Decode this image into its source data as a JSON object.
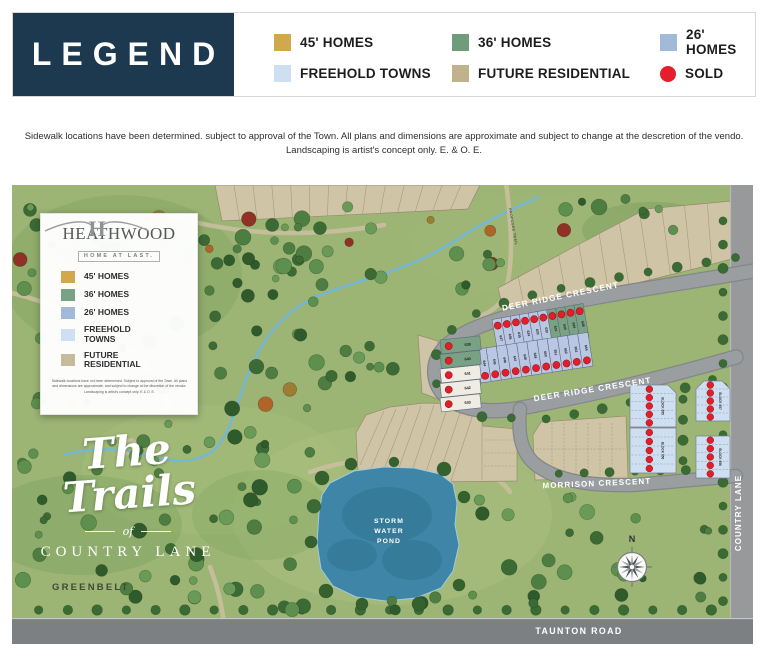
{
  "legend_bar": {
    "title": "LEGEND",
    "rows": [
      [
        {
          "label": "45' HOMES",
          "color": "#d2a84e",
          "shape": "square"
        },
        {
          "label": "36' HOMES",
          "color": "#6f9d7b",
          "shape": "square"
        },
        {
          "label": "26' HOMES",
          "color": "#a3b9d9",
          "shape": "square"
        }
      ],
      [
        {
          "label": "FREEHOLD TOWNS",
          "color": "#cfdff2",
          "shape": "square"
        },
        {
          "label": "FUTURE RESIDENTIAL",
          "color": "#bfb28c",
          "shape": "square"
        },
        {
          "label": "SOLD",
          "color": "#e41f2c",
          "shape": "circle"
        }
      ]
    ]
  },
  "disclaimer": "Sidewalk locations have been determined. subject to approval of the Town. All plans and dimensions are approximate and subject to change at the descretion of the vendo. Landscaping is artist's concept only. E. & O. E.",
  "map": {
    "card": {
      "monogram": "H",
      "brand": "HEATHWOOD",
      "tagline": "HOME AT LAST.",
      "items": [
        {
          "label": "45' HOMES",
          "color": "#d2a84e"
        },
        {
          "label": "36' HOMES",
          "color": "#79a183"
        },
        {
          "label": "26' HOMES",
          "color": "#a3b9d9"
        },
        {
          "label": "FREEHOLD TOWNS",
          "color": "#cfdff2"
        },
        {
          "label": "FUTURE RESIDENTIAL",
          "color": "#c6bb9b"
        }
      ],
      "fine_print": "Sidewalk locations have not been determined. Subject to approval of the Town. All plans and dimensions are approximate, and subject to change at the discretion of the vendor. Landscaping is artist's concept only. E & O. E."
    },
    "logo": {
      "script": "The Trails",
      "of": "of",
      "name": "COUNTRY LANE"
    },
    "labels": {
      "greenbelt": "GREENBELT",
      "pond": [
        "STORM",
        "WATER",
        "POND"
      ],
      "deer_upper": "DEER RIDGE CRESCENT",
      "deer_lower": "DEER RIDGE CRESCENT",
      "morrison": "MORRISON CRESCENT",
      "country": "COUNTRY LANE",
      "taunton": "TAUNTON ROAD",
      "trail": "PROPOSED TRAIL",
      "north": "N"
    },
    "lot_rows": [
      {
        "x0": 480,
        "y0": 134.5,
        "x1": 571,
        "y1": 118.5,
        "h": 34,
        "side": "down",
        "lots": [
          {
            "n": "637",
            "t": "26"
          },
          {
            "n": "636",
            "t": "26"
          },
          {
            "n": "635",
            "t": "26"
          },
          {
            "n": "634",
            "t": "26"
          },
          {
            "n": "633",
            "t": "26"
          },
          {
            "n": "632",
            "t": "26"
          },
          {
            "n": "631",
            "t": "36"
          },
          {
            "n": "630",
            "t": "36"
          },
          {
            "n": "629",
            "t": "36"
          },
          {
            "n": "628",
            "t": "36"
          }
        ]
      },
      {
        "x0": 469,
        "y0": 198,
        "x1": 581,
        "y1": 181,
        "h": 34,
        "side": "up",
        "lots": [
          {
            "n": "644",
            "t": "26"
          },
          {
            "n": "645",
            "t": "26"
          },
          {
            "n": "646",
            "t": "26"
          },
          {
            "n": "647",
            "t": "26"
          },
          {
            "n": "648",
            "t": "26"
          },
          {
            "n": "649",
            "t": "26"
          },
          {
            "n": "650",
            "t": "26"
          },
          {
            "n": "651",
            "t": "26"
          },
          {
            "n": "652",
            "t": "26"
          },
          {
            "n": "653",
            "t": "26"
          },
          {
            "n": "654",
            "t": "26"
          }
        ]
      }
    ],
    "left_lots": {
      "x": 428,
      "w": 40,
      "h": 14,
      "rot": -6,
      "ys": [
        155,
        169.5,
        184,
        198.5,
        213
      ],
      "lots": [
        {
          "n": "639",
          "t": "36"
        },
        {
          "n": "640",
          "t": "36"
        },
        {
          "n": "641",
          "t": "45w"
        },
        {
          "n": "642",
          "t": "45w"
        },
        {
          "n": "643",
          "t": "45w"
        }
      ]
    },
    "blocks": [
      {
        "x": 618,
        "y": 200,
        "w": 46,
        "h": 42,
        "units": 5,
        "label": "BLOCK 655",
        "ch": "r"
      },
      {
        "x": 618,
        "y": 243,
        "w": 46,
        "h": 45,
        "units": 5,
        "label": "BLOCK 656",
        "ch": ""
      },
      {
        "x": 684,
        "y": 196,
        "w": 34,
        "h": 40,
        "units": 5,
        "label": "BLOCK 657",
        "ch": "lr"
      },
      {
        "x": 684,
        "y": 251,
        "w": 34,
        "h": 42,
        "units": 5,
        "label": "BLOCK 658",
        "ch": ""
      }
    ],
    "colors": {
      "26": "#b9c7e4",
      "36": "#79a183",
      "45w": "#efede3",
      "towns": "#cfdff2",
      "sold": "#e11f2a",
      "beige": "#cfc4a5",
      "road": "#9b9ea1",
      "grass": "#9cb474",
      "pond": "#3e85a7",
      "stream": "#74b6da",
      "trail": "#cabf9f"
    }
  }
}
